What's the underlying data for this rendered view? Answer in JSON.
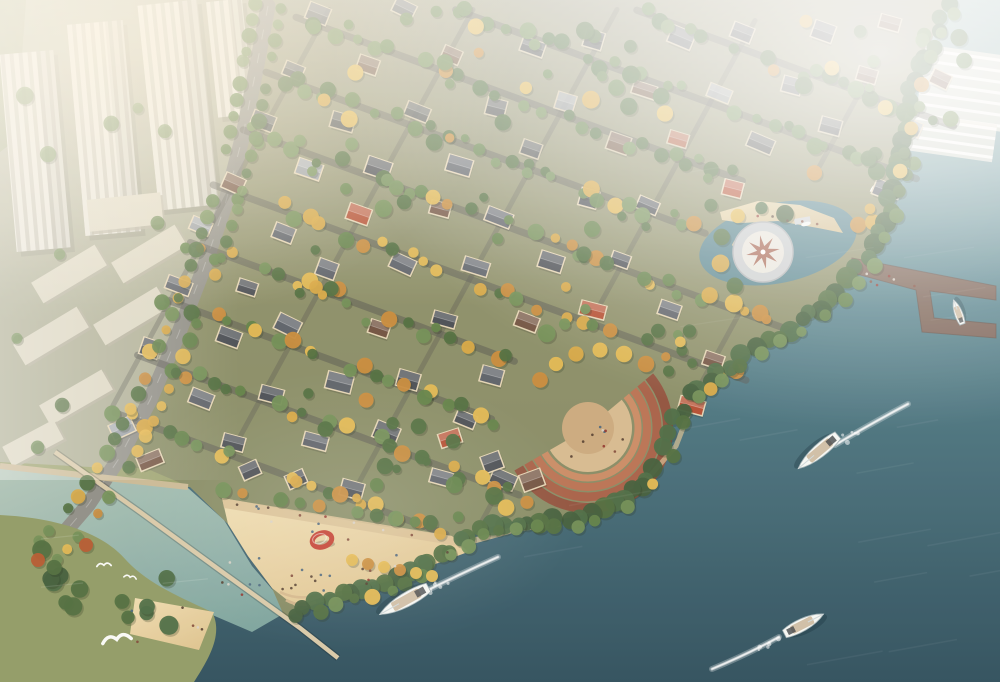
{
  "meta": {
    "type": "aerial-architectural-rendering",
    "subject": "waterfront villa community beside river with beach, piers and boats"
  },
  "colors": {
    "water_top": "#9dbfbf",
    "water_mid": "#57858f",
    "water_deep": "#2b4c5a",
    "cove": "#4d7f8d",
    "lagoon_light": "#c2d3c2",
    "lagoon_deep": "#8fb8ac",
    "land_top": "#c8c4a8",
    "land_mid": "#a3a671",
    "land_low": "#8f9a63",
    "villa_ground": "#73755c",
    "city_ground": "#b2b29c",
    "green_strip": "#9aa37b",
    "sand_light": "#eedcb0",
    "sand_deep": "#dfc48f",
    "promenade": "#d8bf92",
    "road": "#8e8d85",
    "street": "#53544e",
    "wall": "#ead9b8",
    "roof_slate": "#474b51",
    "roof_grey": "#5a5f66",
    "roof_brown": "#6f4f3d",
    "roof_red": "#b34b2e",
    "roof_light": "#9aa0a6",
    "tree_gold": "#d8a640",
    "tree_gold2": "#e4b84f",
    "tree_amber": "#c98a38",
    "tree_green": "#5f7f45",
    "tree_green2": "#4d6b3b",
    "tree_green3": "#6f8d52",
    "tree_dark": "#3f5c38",
    "tree_shore": "#4a6a41",
    "tree_red": "#b5572c",
    "tower_face": "#e9e6da",
    "tower_stripe": "#c9c6b7",
    "slab": "#dcd7c2",
    "slab_side": "#b7b29d",
    "amph_1": "#8f4f3a",
    "amph_2": "#a65e44",
    "amph_3": "#b87050",
    "amph_4": "#c98a62",
    "amph_floor": "#d6b98e",
    "amph_inner": "#caa87c",
    "plaza_ring": "#c9cdcf",
    "plaza_inner": "#e9e6dc",
    "plaza_star": "#9a4f3a",
    "pier": "#7b5f51",
    "jetty": "#d8c8a6",
    "seawall": "#c9b893",
    "boat_white": "#f6f8f5",
    "boat_deck": "#c8b496",
    "boat_dark": "#3c4043",
    "sculpture_red": "#c23b2c",
    "haze": "#ffffff",
    "glow": "#fff3d8",
    "shallow": "#6fa08f"
  },
  "geometry": {
    "land_d": "M0,0 L948,0 L915,80 L898,150 L888,210 L866,258 L838,292 L800,322 L757,349 L718,372 L690,395 L673,420 L664,450 L648,478 L622,500 L592,513 L556,520 L516,521 L478,530 L448,549 L420,567 L388,581 L352,592 L316,604 L285,618 L272,588 L248,556 L228,524 L190,487 L0,466 Z",
    "villa_ground_d": "M262,0 L948,0 L915,80 L898,150 L888,210 L866,258 L838,292 L800,322 L757,349 L718,372 L690,395 L673,420 L664,450 L648,478 L622,500 L592,513 L556,520 L516,521 L478,530 L448,549 L420,567 L388,581 L352,592 L316,604 L285,618 L272,588 L248,556 L228,524 L190,487 L150,470 L112,464 L146,402 L174,338 L200,270 L226,196 L248,92 Z",
    "city_ground_d": "M0,0 L262,0 L248,92 L226,196 L200,270 L172,338 L142,404 L108,468 L0,462 Z",
    "green_strip_d": "M0,0 L26,0 L16,140 L0,152 Z",
    "island_d": "M0,515 C60,518 104,534 126,560 C148,584 182,598 212,612 C224,634 208,660 194,682 L0,682 Z"
  },
  "shoreline": [
    [
      948,
      8
    ],
    [
      915,
      80
    ],
    [
      898,
      150
    ],
    [
      888,
      210
    ],
    [
      866,
      258
    ],
    [
      838,
      292
    ],
    [
      800,
      322
    ],
    [
      757,
      349
    ],
    [
      718,
      372
    ],
    [
      690,
      395
    ],
    [
      673,
      420
    ],
    [
      664,
      450
    ],
    [
      648,
      478
    ],
    [
      622,
      500
    ],
    [
      592,
      513
    ],
    [
      556,
      520
    ],
    [
      516,
      521
    ],
    [
      478,
      530
    ],
    [
      448,
      549
    ],
    [
      420,
      567
    ],
    [
      388,
      581
    ],
    [
      352,
      592
    ],
    [
      316,
      604
    ],
    [
      285,
      618
    ]
  ],
  "road": {
    "points": [
      [
        268,
        6
      ],
      [
        256,
        70
      ],
      [
        243,
        135
      ],
      [
        225,
        205
      ],
      [
        203,
        270
      ],
      [
        178,
        335
      ],
      [
        150,
        400
      ],
      [
        118,
        460
      ],
      [
        88,
        505
      ],
      [
        58,
        540
      ],
      [
        38,
        560
      ]
    ],
    "width": 15
  },
  "grid": {
    "origin": [
      320,
      26
    ],
    "u": [
      60,
      22
    ],
    "v": [
      -30,
      55
    ],
    "i": [
      0,
      10
    ],
    "j": [
      -3,
      8
    ],
    "jitter": 8,
    "row_offset": 14
  },
  "constraints": [
    {
      "lin": [
        340,
        285,
        -365150
      ],
      "max": -2000
    },
    {
      "lin": [
        155,
        430,
        -302600
      ],
      "max": -3000
    },
    {
      "lin": [
        130,
        -360,
        141800
      ],
      "min": 6000
    },
    {
      "lin": [
        1,
        0.45,
        -295
      ],
      "min": 0
    }
  ],
  "avoid": [
    [
      763,
      252,
      58
    ],
    [
      588,
      428,
      95
    ],
    [
      788,
      238,
      70
    ]
  ],
  "bounds": [
    12,
    8,
    978,
    640
  ],
  "villas": {
    "manual": [
      [
        122,
        428,
        -25,
        4
      ],
      [
        150,
        460,
        -22,
        2
      ],
      [
        250,
        470,
        -24,
        0
      ],
      [
        296,
        479,
        -24,
        0
      ],
      [
        450,
        438,
        -18,
        3
      ],
      [
        492,
        462,
        -20,
        0
      ],
      [
        532,
        480,
        -20,
        2
      ]
    ],
    "roof_keys": [
      "roof_slate",
      "roof_grey",
      "roof_brown",
      "roof_red",
      "roof_light"
    ],
    "cumweights": [
      0.42,
      0.64,
      0.82,
      0.9,
      1.0
    ]
  },
  "towers": [
    [
      8,
      52,
      54,
      198,
      -5
    ],
    [
      76,
      22,
      56,
      212,
      -5
    ],
    [
      148,
      2,
      60,
      206,
      -6
    ],
    [
      212,
      0,
      36,
      116,
      -6
    ]
  ],
  "slabs": [
    [
      32,
      262,
      74,
      24,
      -31
    ],
    [
      112,
      242,
      74,
      24,
      -31
    ],
    [
      14,
      324,
      74,
      24,
      -31
    ],
    [
      94,
      304,
      74,
      24,
      -31
    ],
    [
      40,
      386,
      72,
      23,
      -30
    ],
    [
      4,
      432,
      58,
      22,
      -28
    ],
    [
      88,
      196,
      74,
      32,
      -6
    ]
  ],
  "hazy_rows": [
    [
      920,
      50,
      86,
      76,
      8,
      7
    ],
    [
      903,
      118,
      92,
      38,
      8,
      4
    ]
  ],
  "plaza": {
    "center": [
      763,
      252
    ],
    "r_outer": 30,
    "r_inner": 21,
    "star_r": 17,
    "star_r2": 6,
    "cove": [
      778,
      243,
      80,
      40,
      -12
    ],
    "beach": [
      [
        720,
        212
      ],
      [
        758,
        201
      ],
      [
        800,
        205
      ],
      [
        834,
        218
      ],
      [
        843,
        233
      ],
      [
        818,
        228
      ],
      [
        778,
        221
      ],
      [
        742,
        223
      ],
      [
        722,
        220
      ]
    ],
    "dock": [
      794,
      219,
      16,
      6,
      -10
    ],
    "dock_boat": [
      806,
      224
    ]
  },
  "amphitheater": {
    "center": [
      588,
      428
    ],
    "span": [
      -40,
      150
    ],
    "arcs": [
      [
        80,
        "amph_1",
        10
      ],
      [
        69,
        "amph_2",
        9
      ],
      [
        59,
        "amph_3",
        8
      ],
      [
        50,
        "amph_4",
        7
      ]
    ],
    "floor_r": 44,
    "inner_r": 26,
    "trees": [
      [
        540,
        380
      ],
      [
        556,
        364
      ],
      [
        576,
        354
      ],
      [
        600,
        350
      ],
      [
        624,
        354
      ],
      [
        646,
        364
      ]
    ]
  },
  "beach": {
    "poly": [
      [
        222,
        498
      ],
      [
        300,
        512
      ],
      [
        380,
        526
      ],
      [
        452,
        536
      ],
      [
        468,
        552
      ],
      [
        430,
        566
      ],
      [
        380,
        580
      ],
      [
        330,
        594
      ],
      [
        296,
        607
      ],
      [
        272,
        588
      ],
      [
        248,
        556
      ],
      [
        228,
        524
      ]
    ],
    "promenade": [
      [
        222,
        498
      ],
      [
        452,
        536
      ],
      [
        458,
        546
      ],
      [
        224,
        508
      ]
    ],
    "tree_row": [
      [
        352,
        560
      ],
      [
        368,
        564
      ],
      [
        384,
        567
      ],
      [
        400,
        570
      ],
      [
        416,
        573
      ],
      [
        432,
        576
      ]
    ],
    "people": 30
  },
  "sculpture": {
    "pos": [
      322,
      540
    ],
    "rx": 10,
    "ry": 7,
    "rot": -18
  },
  "pier": {
    "deck": [
      [
        852,
        258
      ],
      [
        996,
        286
      ],
      [
        996,
        300
      ],
      [
        930,
        291
      ],
      [
        934,
        318
      ],
      [
        996,
        324
      ],
      [
        996,
        338
      ],
      [
        922,
        332
      ],
      [
        916,
        290
      ],
      [
        849,
        272
      ]
    ]
  },
  "tent": {
    "pos": [
      884,
      196
    ],
    "r": 15,
    "rot": 18
  },
  "jetty": {
    "points": [
      [
        55,
        452
      ],
      [
        140,
        512
      ],
      [
        225,
        574
      ],
      [
        300,
        628
      ],
      [
        338,
        658
      ]
    ]
  },
  "seawall": [
    [
      0,
      466
    ],
    [
      188,
      487
    ]
  ],
  "island": {
    "sand": [
      [
        135,
        598
      ],
      [
        214,
        612
      ],
      [
        199,
        650
      ],
      [
        130,
        634
      ]
    ],
    "red_trees": [
      [
        38,
        560
      ],
      [
        86,
        545
      ]
    ],
    "blobs": [
      [
        55,
        585,
        48,
        8
      ],
      [
        150,
        612,
        40,
        6
      ]
    ]
  },
  "lagoon": {
    "poly": [
      [
        0,
        468
      ],
      [
        188,
        488
      ],
      [
        224,
        520
      ],
      [
        252,
        566
      ],
      [
        290,
        610
      ],
      [
        252,
        632
      ],
      [
        210,
        614
      ],
      [
        150,
        585
      ],
      [
        95,
        560
      ],
      [
        0,
        520
      ]
    ]
  },
  "shallow_patch": [
    560,
    400,
    160,
    60,
    -20
  ],
  "boats": [
    {
      "name": "yacht",
      "pos": [
        818,
        452
      ],
      "angle": 140,
      "len": 52,
      "beam": 15,
      "wake": [
        [
          835,
          445
        ],
        [
          872,
          423
        ],
        [
          908,
          404
        ]
      ]
    },
    {
      "name": "motorboat",
      "pos": [
        804,
        624
      ],
      "angle": -27,
      "len": 44,
      "beam": 14,
      "wake": [
        [
          779,
          637
        ],
        [
          748,
          654
        ],
        [
          712,
          669
        ]
      ]
    },
    {
      "name": "yacht",
      "pos": [
        404,
        601
      ],
      "angle": 151,
      "len": 56,
      "beam": 16,
      "wake": [
        [
          420,
          594
        ],
        [
          460,
          574
        ],
        [
          498,
          557
        ]
      ]
    },
    {
      "name": "moored-boat",
      "pos": [
        958,
        312
      ],
      "angle": -110,
      "len": 26,
      "beam": 9,
      "wake": null
    }
  ],
  "gulls": [
    [
      117,
      641,
      1.6,
      -10
    ],
    [
      104,
      566,
      0.8,
      -4
    ],
    [
      130,
      578,
      0.7,
      10
    ]
  ],
  "people_colors": [
    "#503a2a",
    "#7c4433",
    "#44607a",
    "#8e2f27",
    "#d8d2c6"
  ],
  "trees_cfg": {
    "scatter_count": 150,
    "street_step": 0.24,
    "shore_step": 13,
    "road_step": 17,
    "city_count": 16
  },
  "seed": 11
}
